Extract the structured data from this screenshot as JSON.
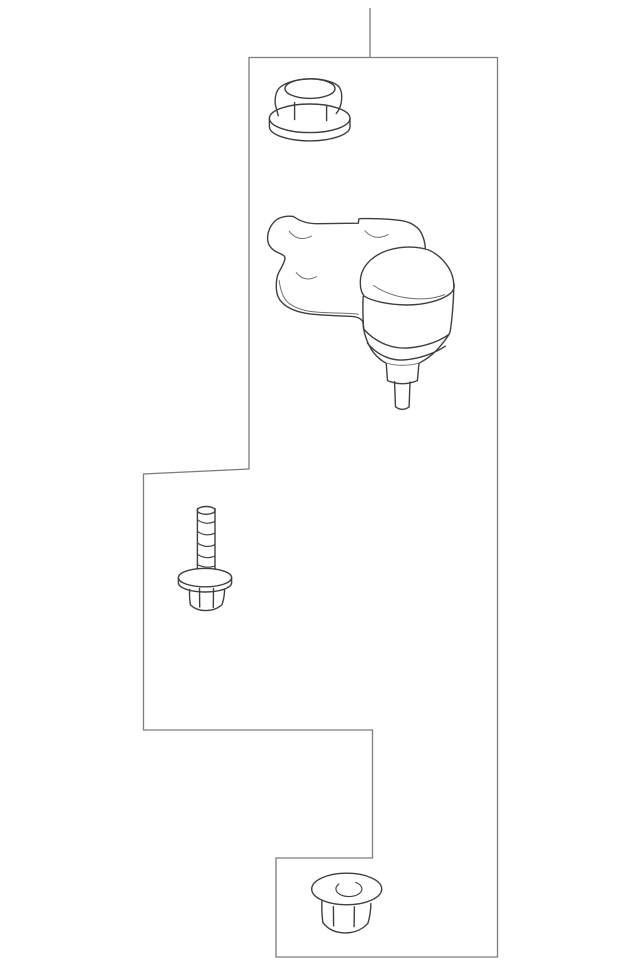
{
  "page": {
    "background_color": "#ffffff"
  },
  "diagram": {
    "type": "auto-parts-line-illustration",
    "frame": {
      "stroke_color": "#7d7d7d",
      "has_callout_leader_line": true
    },
    "line_colors": {
      "primary": "#3f3f3f",
      "detail": "#6f6f6f"
    },
    "parts": [
      {
        "id": "flange-nut-top"
      },
      {
        "id": "ball-joint-assembly"
      },
      {
        "id": "flange-bolt"
      },
      {
        "id": "flange-nut-bottom"
      }
    ]
  }
}
